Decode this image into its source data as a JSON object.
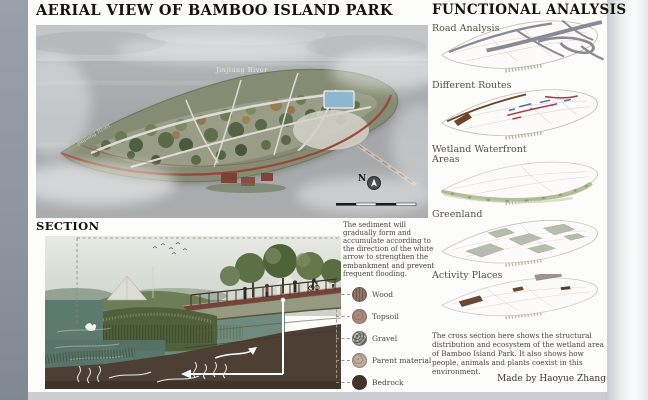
{
  "page": {
    "left_title": "AERIAL VIEW OF BAMBOO ISLAND PARK",
    "section_title": "SECTION",
    "right_title": "FUNCTIONAL ANALYSIS",
    "made_by": "Made by Haoyue Zhang"
  },
  "aerial": {
    "river_label": "Jinjiang River",
    "river_label_left": "Jinjiang River",
    "north_label": "N"
  },
  "section": {
    "note": "The sediment will gradually form and accumulate according to the direction of the white arrow to strengthen the embankment and prevent frequent flooding.",
    "legend": [
      {
        "label": "Wood",
        "color": "#8d7668"
      },
      {
        "label": "Topsoil",
        "color": "#a98a7d"
      },
      {
        "label": "Gravel",
        "color": "#8f9189"
      },
      {
        "label": "Parent material",
        "color": "#bcab9e"
      },
      {
        "label": "Bedrock",
        "color": "#41332a"
      }
    ]
  },
  "functional": {
    "items": [
      {
        "label": "Road Analysis"
      },
      {
        "label": "Different Routes"
      },
      {
        "label": "Wetland Waterfront Areas"
      },
      {
        "label": "Greenland"
      },
      {
        "label": "Activity Places"
      }
    ],
    "description": "The cross section here shows the structural distribution and ecosystem of the wetland area of Bamboo Island Park. It also shows how people, animals and plants coexist in this environment."
  },
  "colors": {
    "road_grey": "#80818a",
    "route_brown": "#6e4226",
    "route_red": "#a93a45",
    "route_blue": "#5668a5",
    "wetland_green": "#a6b488",
    "greenland_patch": "#b7bcb0",
    "activity_brown": "#6b4733",
    "perimeter_red": "#9c4136",
    "pool_blue": "#8fb6ce"
  }
}
